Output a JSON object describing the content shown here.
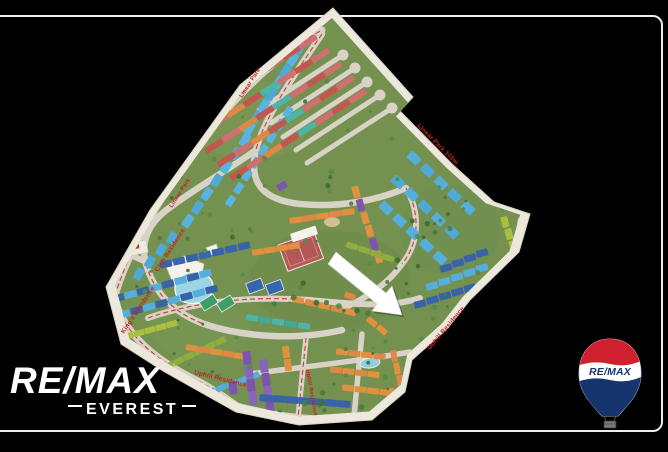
{
  "branding": {
    "agency_name": "RE/MAX",
    "office_name": "EVEREST",
    "balloon_text": "RE/MAX"
  },
  "map": {
    "name": "compound-masterplan",
    "labels": [
      {
        "text": "Club Residence"
      },
      {
        "text": "King's Residence"
      },
      {
        "text": "Uphill Residence"
      },
      {
        "text": "Uphill Residence"
      },
      {
        "text": "Linear Park 100m"
      },
      {
        "text": "Linear Park"
      },
      {
        "text": "Linear Park"
      },
      {
        "text": "Uphill Residence"
      }
    ]
  },
  "colors": {
    "background": "#000000",
    "frame": "#ededed",
    "remax_red": "#d02030",
    "remax_blue": "#16356e",
    "label_red": "#c42222",
    "map_grass": "#74914f",
    "map_paper": "#ece8dc",
    "road": "#d8d3c6",
    "boundary_dash": "#cf3333",
    "arrow": "#ffffff"
  }
}
